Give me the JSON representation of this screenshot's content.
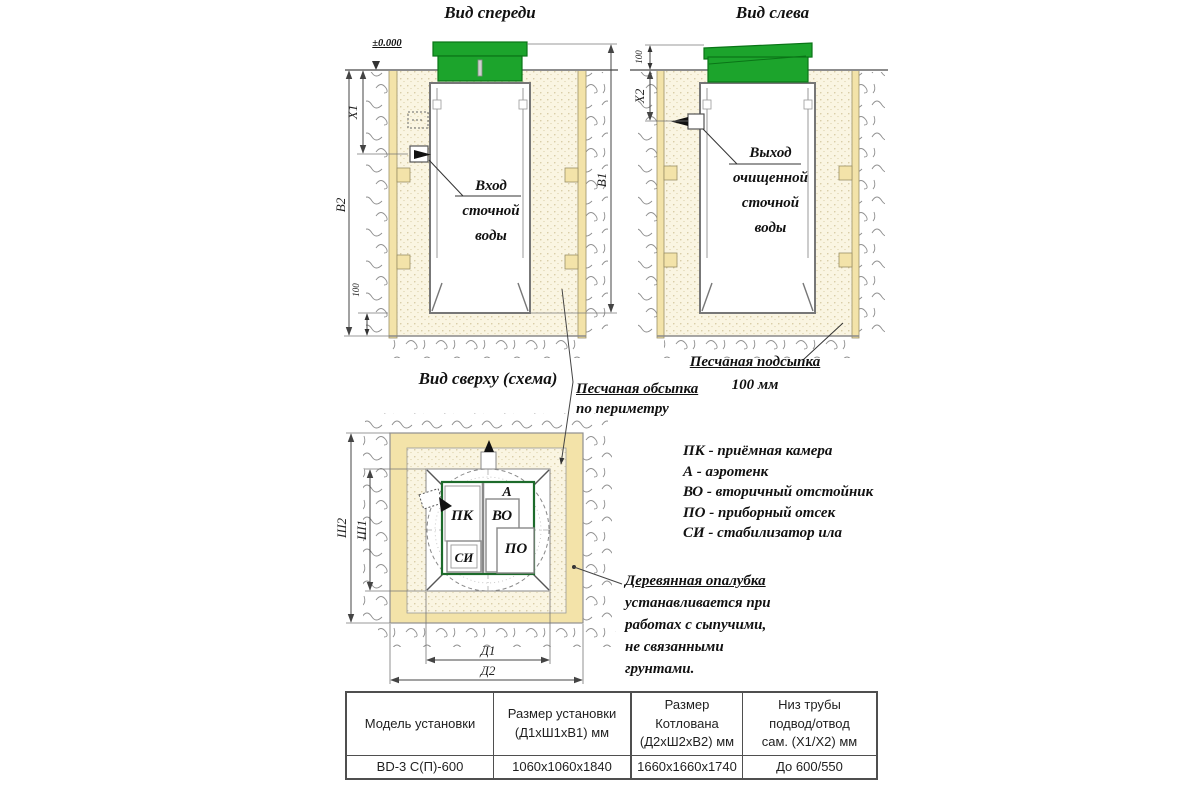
{
  "titles": {
    "front": "Вид спереди",
    "left": "Вид слева",
    "top": "Вид сверху (схема)"
  },
  "level_mark": "±0.000",
  "dims": {
    "x1": "X1",
    "b2": "В2",
    "b1": "В1",
    "bed": "100",
    "x2": "X2",
    "lid": "100",
    "w1": "Ш1",
    "w2": "Ш2",
    "l1": "Д1",
    "l2": "Д2"
  },
  "annotations": {
    "inlet": {
      "l1": "Вход",
      "l2": "сточной",
      "l3": "воды"
    },
    "outlet": {
      "l1": "Выход",
      "l2": "очищенной",
      "l3": "сточной",
      "l4": "воды"
    },
    "bedding": {
      "l1": "Песчаная подсыпка",
      "l2": "100 мм"
    },
    "backfill": {
      "l1": "Песчаная обсыпка",
      "l2": "по периметру"
    },
    "formwork": {
      "l1": "Деревянная опалубка",
      "l2": "устанавливается при",
      "l3": "работах с сыпучими,",
      "l4": "не связанными",
      "l5": "грунтами."
    }
  },
  "compartments": {
    "pk": "ПК",
    "a": "А",
    "vo": "ВО",
    "po": "ПО",
    "si": "СИ"
  },
  "legend": {
    "items": [
      "ПК - приёмная камера",
      "А - аэротенк",
      "ВО - вторичный отстойник",
      "ПО - приборный отсек",
      "СИ - стабилизатор ила"
    ]
  },
  "table": {
    "col1": {
      "h1": "Модель установки"
    },
    "col2": {
      "h1": "Размер установки",
      "h2": "(Д1хШ1хВ1) мм"
    },
    "col3": {
      "h1": "Размер",
      "h2": "Котлована",
      "h3": "(Д2хШ2хВ2) мм"
    },
    "col4": {
      "h1": "Низ трубы",
      "h2": "подвод/отвод",
      "h3": "сам. (Х1/Х2) мм"
    },
    "row": {
      "model": "BD-3 С(П)-600",
      "unit": "1060х1060х1840",
      "pit": "1660х1660х1740",
      "pipe": "До 600/550"
    }
  },
  "colors": {
    "lid_green": "#1ca42c",
    "lid_green_dark": "#0a7417",
    "wood": "#f3e3a9",
    "sand_bg": "#faf5e2",
    "tank_outline_green": "#1d6b2b",
    "line_gray": "#7a7a7a",
    "dim_gray": "#444444"
  }
}
